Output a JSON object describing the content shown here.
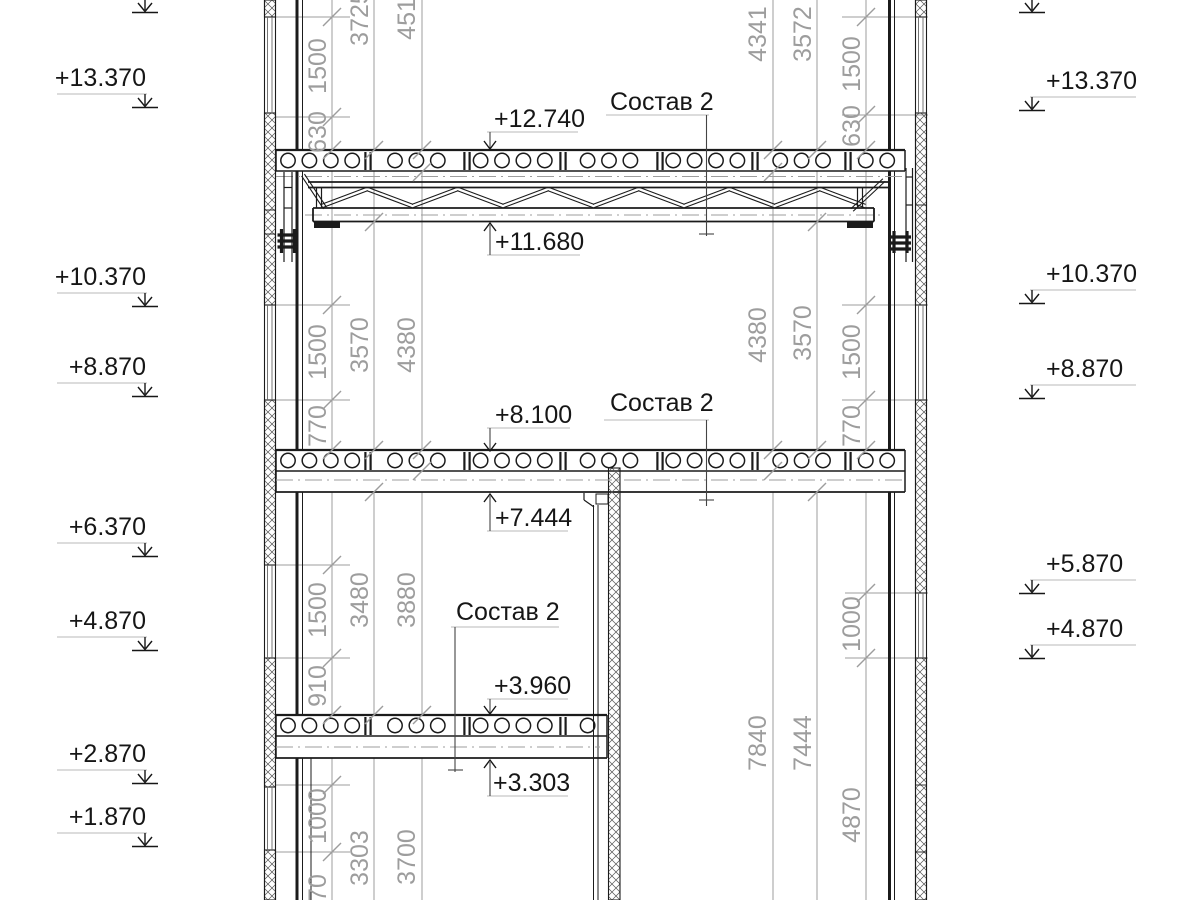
{
  "colors": {
    "line_color": "#1b1b1b",
    "dim_color": "#9d9d9d",
    "underline_color": "#b8b8b8"
  },
  "elevations_left": [
    "+13.370",
    "+10.370",
    "+8.870",
    "+6.370",
    "+4.870",
    "+2.870",
    "+1.870"
  ],
  "elevations_right": [
    "+13.370",
    "+10.370",
    "+8.870",
    "+5.870",
    "+4.870"
  ],
  "levels": [
    "+12.740",
    "+11.680",
    "+8.100",
    "+7.444",
    "+3.960",
    "+3.303"
  ],
  "compositions": [
    "Состав 2",
    "Состав 2",
    "Состав 2"
  ],
  "dims_left": [
    "1500",
    "630",
    "3725",
    "4516",
    "1500",
    "770",
    "3570",
    "4380",
    "1500",
    "910",
    "3480",
    "3880",
    "1000",
    "970",
    "3303",
    "3700"
  ],
  "dims_right": [
    "4341",
    "3572",
    "1500",
    "630",
    "4380",
    "3570",
    "1500",
    "770",
    "1000",
    "7840",
    "7444",
    "4870"
  ]
}
